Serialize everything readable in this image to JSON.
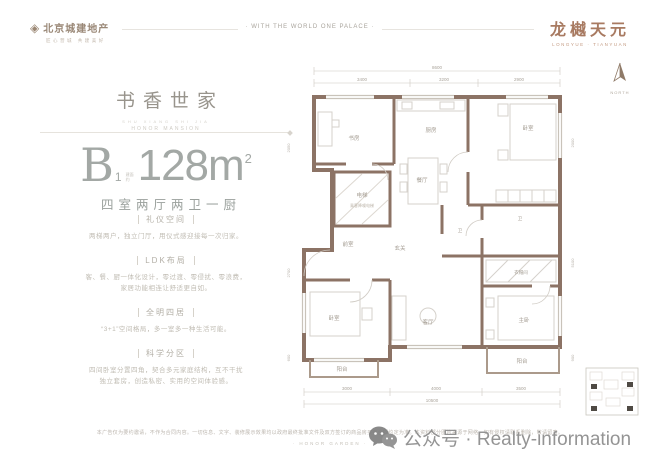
{
  "header": {
    "logo_title": "北京城建地产",
    "logo_tagline": "匠心营城 共建美好",
    "logo_mark": "diamond",
    "center_motto": "· WITH THE WORLD ONE PALACE ·",
    "brand": "龙樾天元",
    "brand_sub": "LONGYUE · TIANYUAN"
  },
  "panel": {
    "title": "书香世家",
    "subtitle_pinyin": "SHU XIANG SHI JIA",
    "subtitle_en": "HONOR MANSION",
    "unit_letter": "B",
    "unit_index": "1",
    "unit_note_top": "建面",
    "unit_note_bottom": "约",
    "area_value": "128m",
    "area_sup": "2",
    "layout": "四室两厅两卫一厨",
    "sections": [
      {
        "title": "礼仪空间",
        "lines": [
          "两梯两户，独立门厅，用仪式感迎接每一次归家。"
        ]
      },
      {
        "title": "LDK布局",
        "lines": [
          "客、餐、厨一体化设计，零过渡、零侵扰、零浪费，",
          "家居功能相连让舒适更自如。"
        ]
      },
      {
        "title": "全明四居",
        "lines": [
          "“3+1”空间格局，多一室多一种生活可能。"
        ]
      },
      {
        "title": "科学分区",
        "lines": [
          "四间卧室分置四角，契合多元家庭结构，互不干扰",
          "独立套房，创造私密、实用的空间体验感。"
        ]
      }
    ]
  },
  "plan": {
    "north_label": "NORTH",
    "rooms": {
      "study": "书房",
      "kitchen": "厨房",
      "bedroom_top": "卧室",
      "dining": "餐厅",
      "elevator": "电梯",
      "elevator_sub": "乘客降噪电梯",
      "lobby": "前室",
      "foyer": "玄关",
      "living": "客厅",
      "bedroom_left": "卧室",
      "master": "主卧",
      "bath_center": "卫",
      "bath_right": "卫",
      "closet": "衣帽间",
      "balcony_left": "阳台",
      "balcony_right": "阳台"
    },
    "dims": {
      "top_total": "8600",
      "top_segments": [
        "3400",
        "3200",
        "2900"
      ],
      "bottom_total": "10500",
      "bottom_segments": [
        "3000",
        "4000",
        "3500"
      ],
      "left": [
        "2050",
        "2700",
        "600"
      ],
      "right": [
        "2000",
        "5100",
        "900"
      ]
    }
  },
  "footer": {
    "disclaimer": "本广告仅为要约邀请，不作为合同内容。一切信息、文字、装修展示效果均以政府最终批准文件及双方签订的商品房买卖合同约定为准。本资料部分图片来源于网络，如有侵权请联系删除，敬请留意。",
    "motto": "· HONOR GARDEN ·"
  },
  "watermark": {
    "label": "公众号 · Realty-information"
  },
  "colors": {
    "wall": "#8c7365",
    "brand": "#a87a61",
    "gray": "#a3a8a5"
  }
}
